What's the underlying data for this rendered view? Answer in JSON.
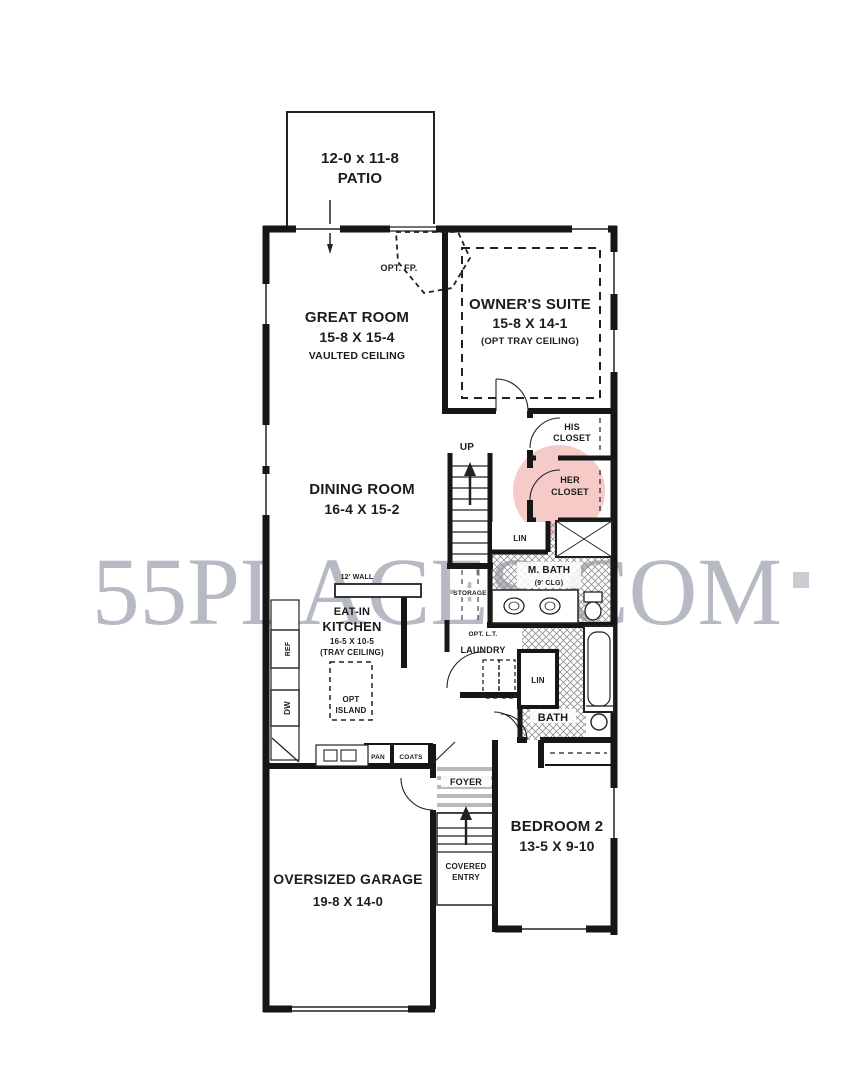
{
  "plan": {
    "patio": {
      "dims": "12-0 x 11-8",
      "name": "PATIO"
    },
    "great_room": {
      "name": "GREAT ROOM",
      "dims": "15-8 X 15-4",
      "note": "VAULTED CEILING"
    },
    "owners_suite": {
      "name": "OWNER'S SUITE",
      "dims": "15-8 X 14-1",
      "note": "(OPT TRAY CEILING)"
    },
    "his_closet": {
      "l1": "HIS",
      "l2": "CLOSET"
    },
    "her_closet": {
      "l1": "HER",
      "l2": "CLOSET"
    },
    "dining_room": {
      "name": "DINING ROOM",
      "dims": "16-4 X 15-2"
    },
    "kitchen": {
      "l1": "EAT-IN",
      "l2": "KITCHEN",
      "dims": "16-5 X 10-5",
      "note": "(TRAY CEILING)"
    },
    "master_bath": {
      "name": "M. BATH",
      "note": "(9' CLG)"
    },
    "laundry": {
      "name": "LAUNDRY",
      "note": "OPT. L.T."
    },
    "bath": {
      "name": "BATH"
    },
    "foyer": {
      "name": "FOYER"
    },
    "covered_entry": {
      "l1": "COVERED",
      "l2": "ENTRY"
    },
    "bedroom2": {
      "name": "BEDROOM 2",
      "dims": "13-5 X 9-10"
    },
    "garage": {
      "name": "OVERSIZED GARAGE",
      "dims": "19-8 X 14-0"
    },
    "annotations": {
      "opt_fp": "OPT. FP.",
      "up": "UP",
      "storage": "STORAGE",
      "lin": "LIN",
      "lin2": "LIN",
      "ref": "REF",
      "dw": "DW",
      "opt_island_l1": "OPT",
      "opt_island_l2": "ISLAND",
      "pan": "PAN",
      "coats": "COATS",
      "wall12": "12' WALL"
    }
  },
  "watermark": {
    "text": "55PLACES.COM"
  },
  "colors": {
    "highlight": "#ec9f99",
    "watermark": "#b6bac2",
    "hatch": "#8f8f8f"
  }
}
